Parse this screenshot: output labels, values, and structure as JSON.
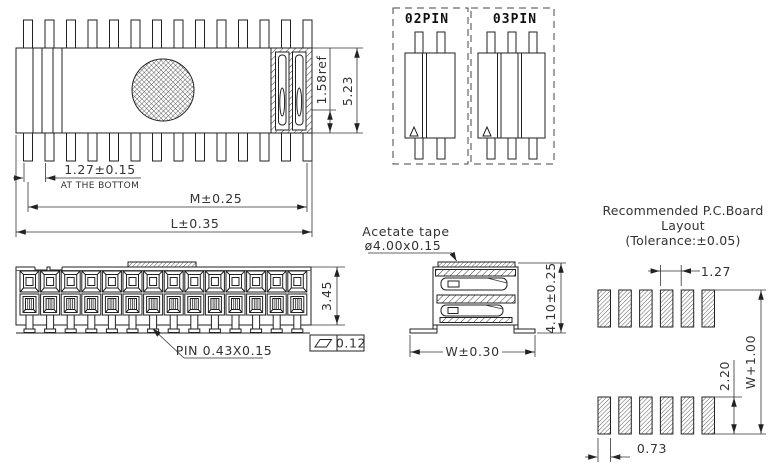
{
  "drawing_title": "Connector engineering drawing",
  "top_view": {
    "pitch": "1.27±0.15",
    "pitch_note": "AT THE BOTTOM",
    "m": "M±0.25",
    "l": "L±0.35",
    "ref": "1.58ref",
    "height": "5.23"
  },
  "variants": {
    "two": "02PIN",
    "three": "03PIN"
  },
  "front_view": {
    "height": "3.45",
    "pin": "PIN 0.43X0.15",
    "flatness": "0.12"
  },
  "side_view": {
    "tape1": "Acetate tape",
    "tape2": "ø4.00x0.15",
    "w": "W±0.30",
    "h": "4.10±0.25"
  },
  "pcb": {
    "t1": "Recommended P.C.Board",
    "t2": "Layout",
    "t3": "(Tolerance:±0.05)",
    "pitch": "1.27",
    "pad_len": "2.20",
    "overall": "W+1.00",
    "pad_w": "0.73"
  }
}
